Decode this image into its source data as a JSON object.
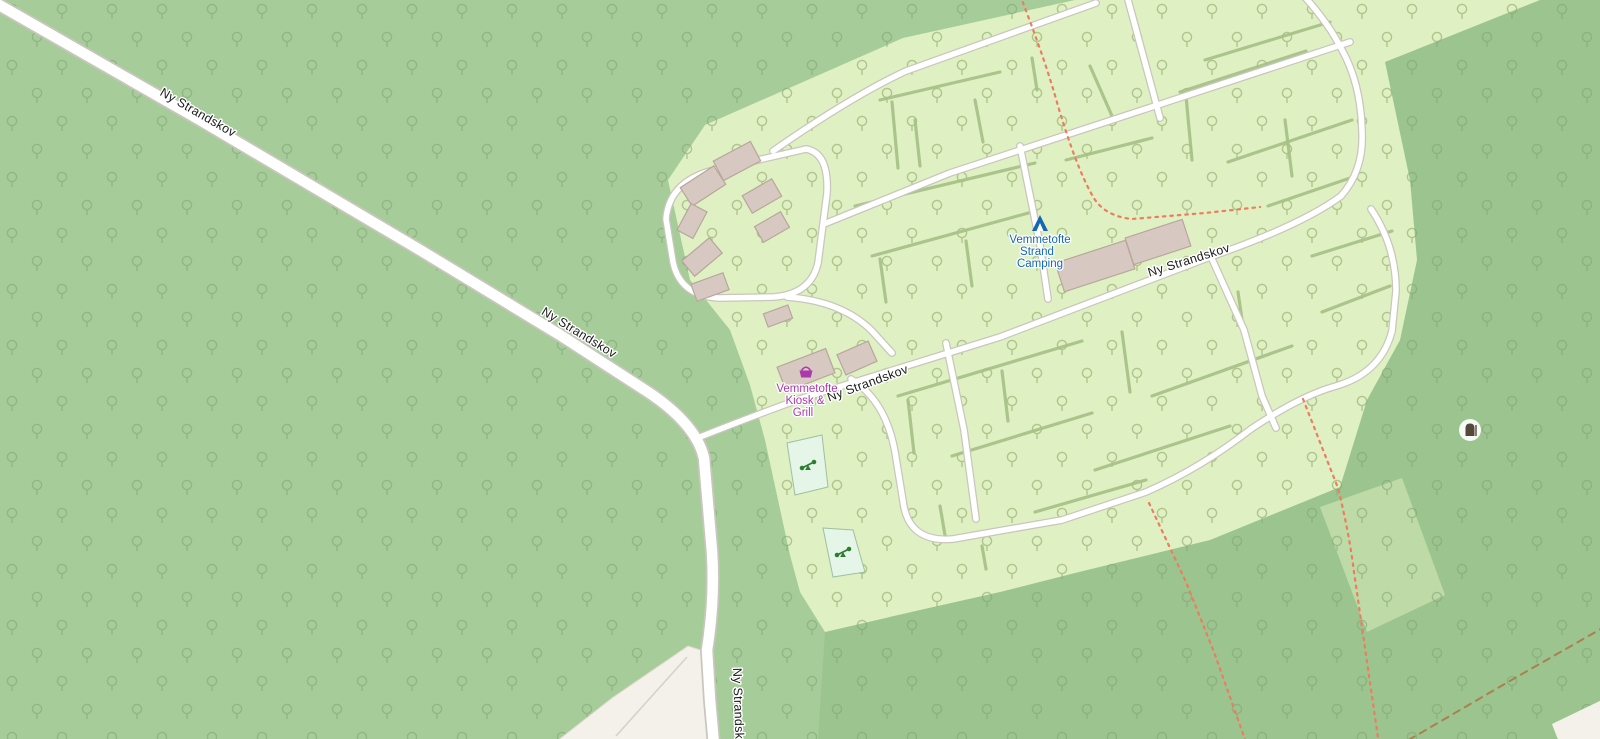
{
  "map": {
    "roads": {
      "main_label": "Ny Strandskov",
      "south_label": "Ny Strandskov"
    },
    "pois": {
      "campsite": {
        "line1": "Vemmetofte",
        "line2": "Strand",
        "line3": "Camping"
      },
      "kiosk": {
        "line1": "Vemmetofte",
        "line2": "Kiosk &",
        "line3": "Grill"
      }
    },
    "icons": [
      "tent-icon",
      "shopping-basket-icon",
      "hunting-stand-icon",
      "playground-icon",
      "tree-icon"
    ],
    "colors": {
      "forest": "#a6cd99",
      "forest_dark": "#9cc48e",
      "camp": "#dff0c2",
      "clearing": "#bedaa6",
      "tree_forest": "#7ea473",
      "tree_camp": "#a3ba7e",
      "hedge": "#a6c086",
      "road_casing": "#c9c6bd",
      "road_fill": "#ffffff",
      "path_color": "#ec7d60",
      "track_color": "#ab8050",
      "building": "#d7c8c1",
      "building_outline": "#b7a79c",
      "playground_fill": "#e5f5e7",
      "playground_stroke": "#9cc1a2",
      "playground_icon": "#2f7d32",
      "beach": "#f3f1ea",
      "beach_stroke": "#ded9cc",
      "label": "#1b1b1b",
      "camp_label": "#1268b3",
      "shop_label": "#ac39ac",
      "stand_icon": "#55493c"
    }
  }
}
